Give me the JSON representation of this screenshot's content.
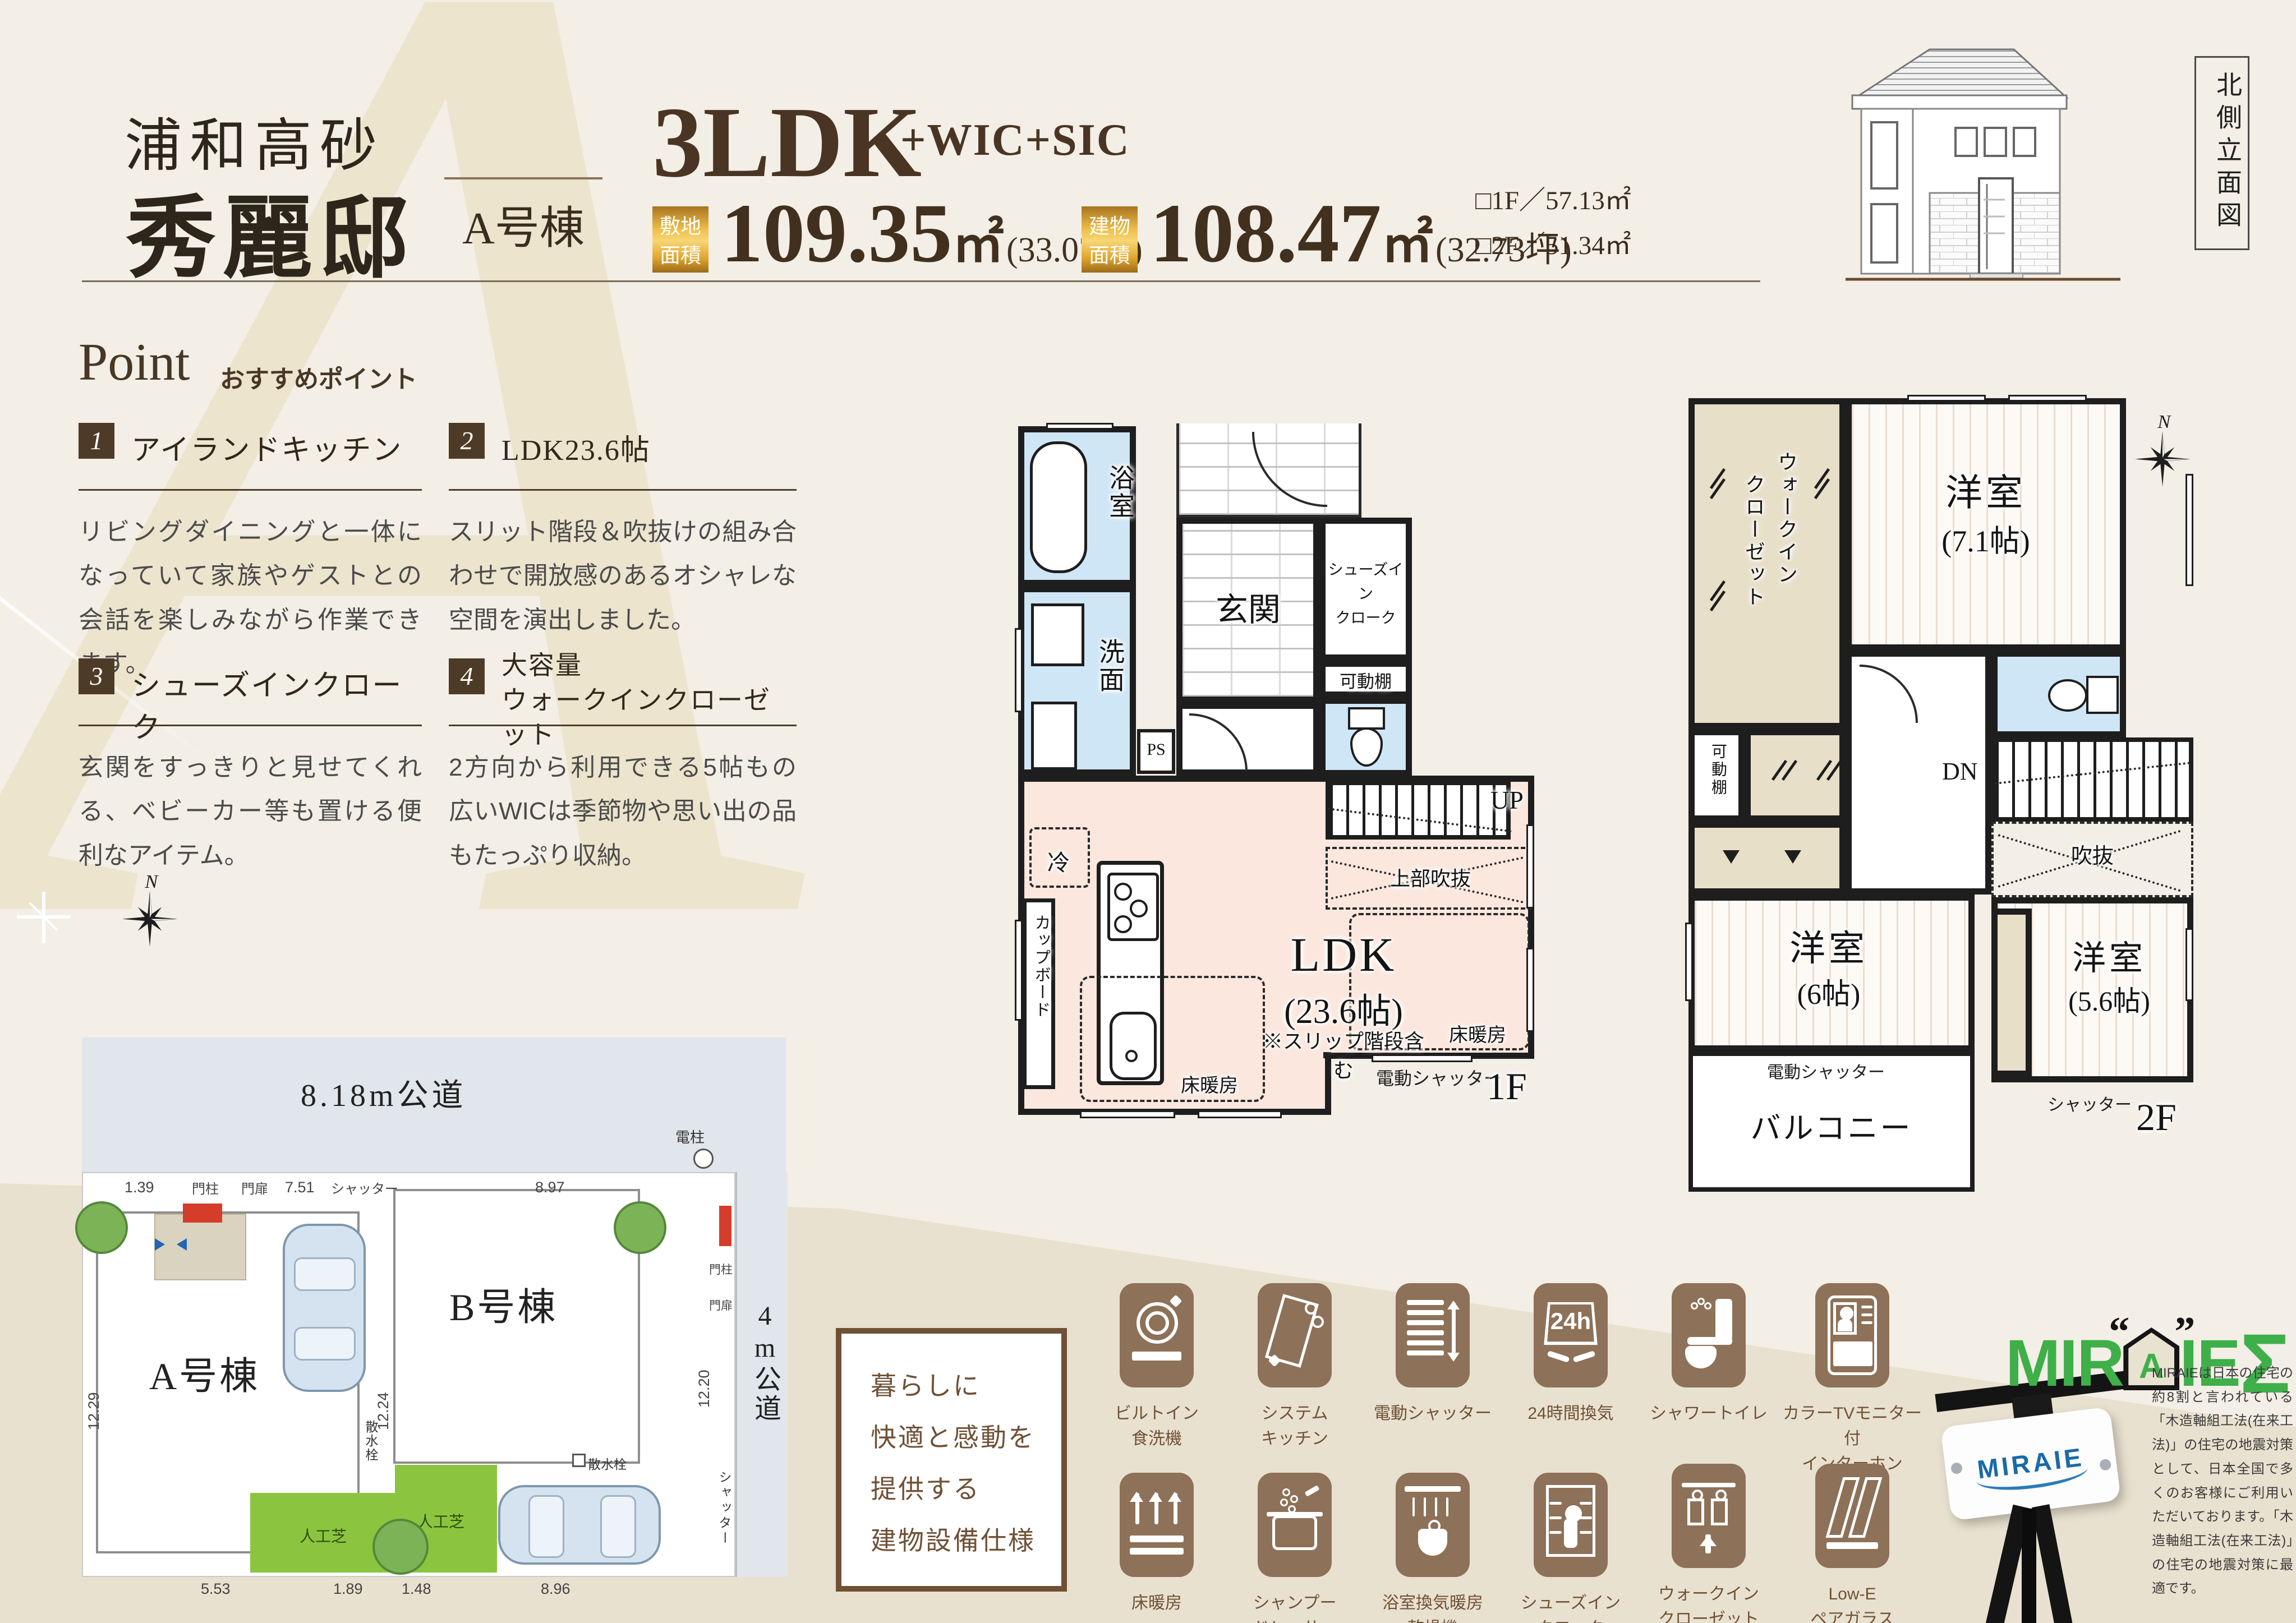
{
  "h": {
    "loc": "浦和高砂",
    "name": "秀麗邸",
    "unit": "A号棟",
    "type": "3LDK",
    "suffix": "+WIC+SIC",
    "land_badge": "敷地\n面積",
    "land_val": "109.35",
    "land_unit": "㎡",
    "land_tsubo": "(33.07坪)",
    "bldg_badge": "建物\n面積",
    "bldg_val": "108.47",
    "bldg_unit": "㎡",
    "bldg_tsubo": "(32.73坪)",
    "f1_area": "□1F／57.13㎡",
    "f2_area": "□2F／51.34㎡",
    "elev": "北側立面図"
  },
  "p": {
    "title": "Point",
    "sub": "おすすめポイント",
    "items": [
      {
        "no": "1",
        "title": "アイランドキッチン",
        "body": "リビングダイニングと一体になっていて家族やゲストとの会話を楽しみながら作業できます。"
      },
      {
        "no": "2",
        "title": "LDK23.6帖",
        "body": "スリット階段＆吹抜けの組み合わせで開放感のあるオシャレな空間を演出しました。"
      },
      {
        "no": "3",
        "title": "シューズインクローク",
        "body": "玄関をすっきりと見せてくれる、ベビーカー等も置ける便利なアイテム。"
      },
      {
        "no": "4",
        "title": "大容量\nウォークインクローゼット",
        "body": "2方向から利用できる5帖もの広いWICは季節物や思い出の品もたっぷり収納。"
      }
    ]
  },
  "f1": {
    "bath": "浴室",
    "wash": "洗面",
    "ps": "PS",
    "genkan": "玄関",
    "sic": "シューズイン\nクローク",
    "shelf": "可動棚",
    "cold": "冷",
    "cup": "カップボード",
    "ldk": "LDK",
    "ldk_size": "(23.6帖)",
    "note": "※スリップ階段含む",
    "void": "上部吹抜",
    "up": "UP",
    "heat": "床暖房",
    "eshutter": "電動シャッター",
    "fl": "1F"
  },
  "f2": {
    "wic_a": "ウォークイン",
    "wic_b": "クローゼット",
    "shelf": "可動棚",
    "room": "洋室",
    "s71": "(7.1帖)",
    "s6": "(6帖)",
    "s56": "(5.6帖)",
    "void": "吹抜",
    "dn": "DN",
    "balcony": "バルコニー",
    "eshutter": "電動シャッター",
    "shutter": "シャッター",
    "fl": "2F"
  },
  "c": {
    "n": "N"
  },
  "s": {
    "road_top": "8.18m公道",
    "road_right": "4m公道",
    "ha": "A号棟",
    "hb": "B号棟",
    "pole": "電柱",
    "gp": "門柱",
    "gd": "門扉",
    "shutter": "シャッター",
    "tap": "散水栓",
    "turf": "人工芝",
    "d_139": "1.39",
    "d_751": "7.51",
    "d_897": "8.97",
    "d_1229": "12.29",
    "d_1224": "12.24",
    "d_1220": "12.20",
    "d_553": "5.53",
    "d_189": "1.89",
    "d_148": "1.48",
    "d_896": "8.96"
  },
  "e": {
    "intro": "暮らしに\n快適と感動を\n提供する\n建物設備仕様",
    "vent24": "24h",
    "l1": "ビルトイン\n食洗機",
    "l2": "システム\nキッチン",
    "l3": "電動シャッター",
    "l4": "24時間換気",
    "l5": "床暖房",
    "l6": "シャンプー\nドレッサー",
    "l7": "浴室換気暖房\n乾燥機",
    "l8": "シューズイン\nクローク",
    "l9": "シャワートイレ",
    "l10": "カラーTVモニター付\nインターホン",
    "l11": "ウォークイン\nクローゼット",
    "l12": "Low-E\nペアガラス"
  },
  "m": {
    "mir": "MIR",
    "a": "A",
    "ie": "IE",
    "sigma": "Σ",
    "qo": "“",
    "qc": "”",
    "plate": "MIRAIE",
    "desc": "MIRAIEは日本の住宅の約8割と言われている「木造軸組工法(在来工法)」の住宅の地震対策として、日本全国で多くのお客様にご利用いただいております。「木造軸組工法(在来工法)」の住宅の地震対策に最適です。"
  },
  "wm": "A"
}
